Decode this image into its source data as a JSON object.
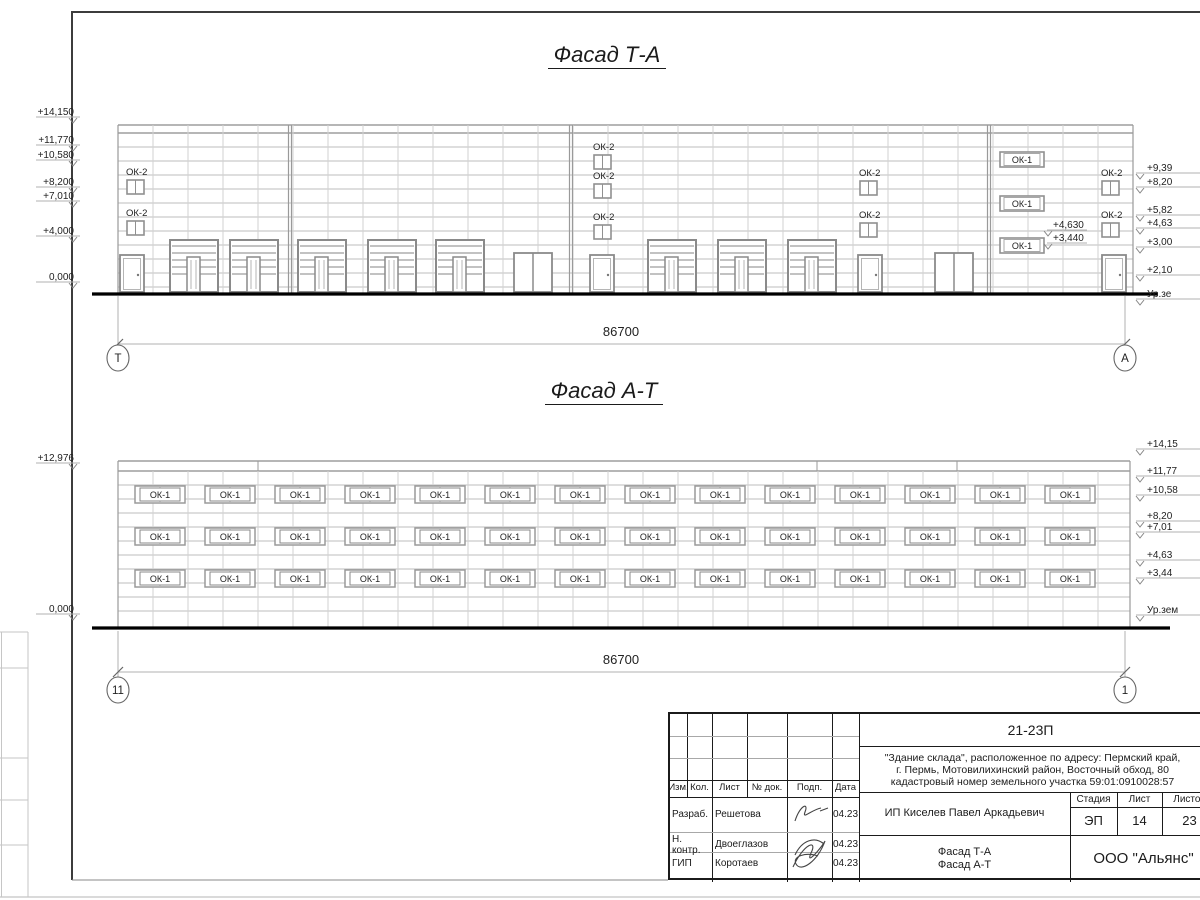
{
  "facade_ta": {
    "title": "Фасад Т-А",
    "dim_label": "86700",
    "axis_left": "Т",
    "axis_right": "А",
    "ok2_label": "ОК-2",
    "ok1_label": "ОК-1",
    "elev_left": [
      {
        "text": "+14,150",
        "y": 111
      },
      {
        "text": "+11,770",
        "y": 139
      },
      {
        "text": "+10,580",
        "y": 154
      },
      {
        "text": "+8,200",
        "y": 181
      },
      {
        "text": "+7,010",
        "y": 195
      },
      {
        "text": "+4,000",
        "y": 230
      },
      {
        "text": "0,000",
        "y": 276
      }
    ],
    "elev_right": [
      {
        "text": "+9,39",
        "y": 167
      },
      {
        "text": "+8,20",
        "y": 181
      },
      {
        "text": "+5,82",
        "y": 209
      },
      {
        "text": "+4,63",
        "y": 222
      },
      {
        "text": "+3,00",
        "y": 241
      },
      {
        "text": "+2,10",
        "y": 269
      },
      {
        "text": "Ур.зе",
        "y": 293
      }
    ],
    "inline_marks": [
      {
        "text": "+4,630",
        "x": 1053,
        "y": 224
      },
      {
        "text": "+3,440",
        "x": 1053,
        "y": 237
      }
    ],
    "ok2_columns": [
      {
        "x": 127,
        "windows": [
          {
            "label_y": 175,
            "win_y": 180
          },
          {
            "label_y": 216,
            "win_y": 221
          }
        ]
      },
      {
        "x": 594,
        "windows": [
          {
            "label_y": 150,
            "win_y": 155
          },
          {
            "label_y": 179,
            "win_y": 184
          },
          {
            "label_y": 220,
            "win_y": 225
          }
        ]
      },
      {
        "x": 860,
        "windows": [
          {
            "label_y": 176,
            "win_y": 181
          },
          {
            "label_y": 218,
            "win_y": 223
          }
        ]
      },
      {
        "x": 1102,
        "windows": [
          {
            "label_y": 176,
            "win_y": 181
          },
          {
            "label_y": 218,
            "win_y": 223
          }
        ]
      }
    ],
    "ok1_x": 1000,
    "ok1_windows_y": [
      152,
      196,
      238
    ],
    "gates_x": [
      170,
      230,
      298,
      368,
      436,
      648,
      718,
      788
    ],
    "doors_x": [
      120,
      590,
      858,
      1102
    ],
    "double_doors_x": [
      514,
      935
    ]
  },
  "facade_at": {
    "title": "Фасад А-Т",
    "dim_label": "86700",
    "axis_left": "11",
    "axis_right": "1",
    "window_label": "ОК-1",
    "elev_left": [
      {
        "text": "+12,976",
        "y": 457
      },
      {
        "text": "0,000",
        "y": 608
      }
    ],
    "elev_right": [
      {
        "text": "+14,15",
        "y": 443
      },
      {
        "text": "+11,77",
        "y": 470
      },
      {
        "text": "+10,58",
        "y": 489
      },
      {
        "text": "+8,20",
        "y": 515
      },
      {
        "text": "+7,01",
        "y": 526
      },
      {
        "text": "+4,63",
        "y": 554
      },
      {
        "text": "+3,44",
        "y": 572
      },
      {
        "text": "Ур.зем",
        "y": 609
      }
    ],
    "window_rows_y": [
      486,
      528,
      570
    ],
    "window_cols_x": [
      135,
      205,
      275,
      345,
      415,
      485,
      555,
      625,
      695,
      765,
      835,
      905,
      975,
      1045
    ]
  },
  "titleblock": {
    "doc_number": "21-23П",
    "description_lines": [
      "\"Здание склада\", расположенное по адресу: Пермский край,",
      "г. Пермь, Мотовилихинский район, Восточный обход, 80",
      "кадастровый номер земельного участка 59:01:0910028:57"
    ],
    "client": "ИП Киселев Павел Аркадьевич",
    "sheet_name_line1": "Фасад Т-А",
    "sheet_name_line2": "Фасад А-Т",
    "organization": "ООО \"Альянс\"",
    "col_headers": [
      "Изм.",
      "Кол.",
      "Лист",
      "№ док.",
      "Подп.",
      "Дата"
    ],
    "stage_header": "Стадия",
    "sheet_header": "Лист",
    "sheets_header": "Листов",
    "stage": "ЭП",
    "sheet_no": "14",
    "sheets_total": "23",
    "roles": [
      {
        "role": "Разраб.",
        "name": "Решетова",
        "date": "04.23"
      },
      {
        "role": "Н. контр.",
        "name": "Двоеглазов",
        "date": "04.23"
      },
      {
        "role": "ГИП",
        "name": "Коротаев",
        "date": "04.23"
      }
    ]
  }
}
